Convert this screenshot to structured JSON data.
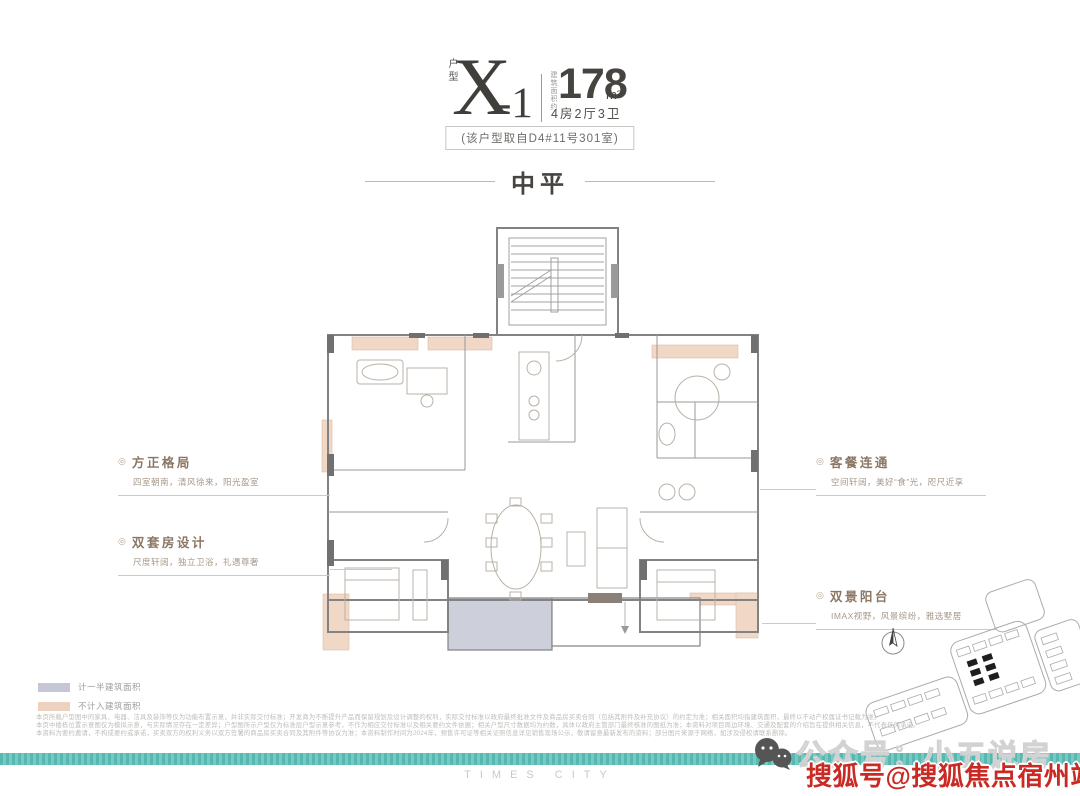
{
  "header": {
    "unit_label": "户型",
    "unit_code_main": "X",
    "unit_code_suffix": "-1",
    "area_prefix": "建筑面积约",
    "area_value": "178",
    "area_unit": "m²",
    "rooms_line": "4房2厅3卫",
    "source_note": "(该户型取自D4#11号301室)"
  },
  "section_title": "中平",
  "annotations": {
    "left": [
      {
        "marker": "◎",
        "title": "方正格局",
        "desc": "四室朝南，清风徐来，阳光盈室"
      },
      {
        "marker": "◎",
        "title": "双套房设计",
        "desc": "尺度轩阔，独立卫浴，礼遇尊奢"
      }
    ],
    "right": [
      {
        "marker": "◎",
        "title": "客餐连通",
        "desc": "空间轩阔，美好“食”光，咫尺近享"
      },
      {
        "marker": "◎",
        "title": "双景阳台",
        "desc": "IMAX视野，风景缤纷，雅选墅居"
      }
    ]
  },
  "legend": {
    "items": [
      {
        "label": "计一半建筑面积",
        "color": "#c6c7d4"
      },
      {
        "label": "不计入建筑面积",
        "color": "#eed2c0"
      }
    ]
  },
  "disclaimer": [
    "本页所载户型图中的家具、电器、洁具及装饰等仅为功能布置示意，并非实际交付标准；开发商为不断提升产品而保留规划及设计调整的权利，实际交付标准以政府最终批准文件及商品房买卖合同（包括其附件及补充协议）的约定为准；相关面积均指建筑面积，最终以不动产权属证书记载为准。",
    "本页中楼栋位置示意图仅为模拟示意，与实际情况存在一定差异；户型图所示户型仅为标准层户型示意参考，不作为相应交付标准以及相关要约文件依据；相关户型尺寸数据均为约数，具体以政府主管部门最终核准的图纸为准；本资料对项目周边环境、交通及配套的介绍旨在提供相关信息，不代表任何承诺。",
    "本资料为要约邀请，不构成要约或承诺，买卖双方的权利义务以双方签署的商品房买卖合同及其附件等协议为准；本资料制作时间为2024年，预售许可证等相关证照信息详见销售现场公示，敬请留意最新发布的资料；部分图片来源于网络，如涉及侵权请联系删除。"
  ],
  "watermarks": {
    "wechat_text": "公众号：小五说房",
    "sohu_text": "搜狐号@搜狐焦点宿州站"
  },
  "brand": "TIMES CITY",
  "colors": {
    "teal_band": "#5fbfb7",
    "salmon_area": "#f1d7c5",
    "half_area_gray": "#c6c7d4",
    "wall_dark": "#707070",
    "annotation_brown": "#8a7663",
    "watermark_red": "#c92a24"
  }
}
